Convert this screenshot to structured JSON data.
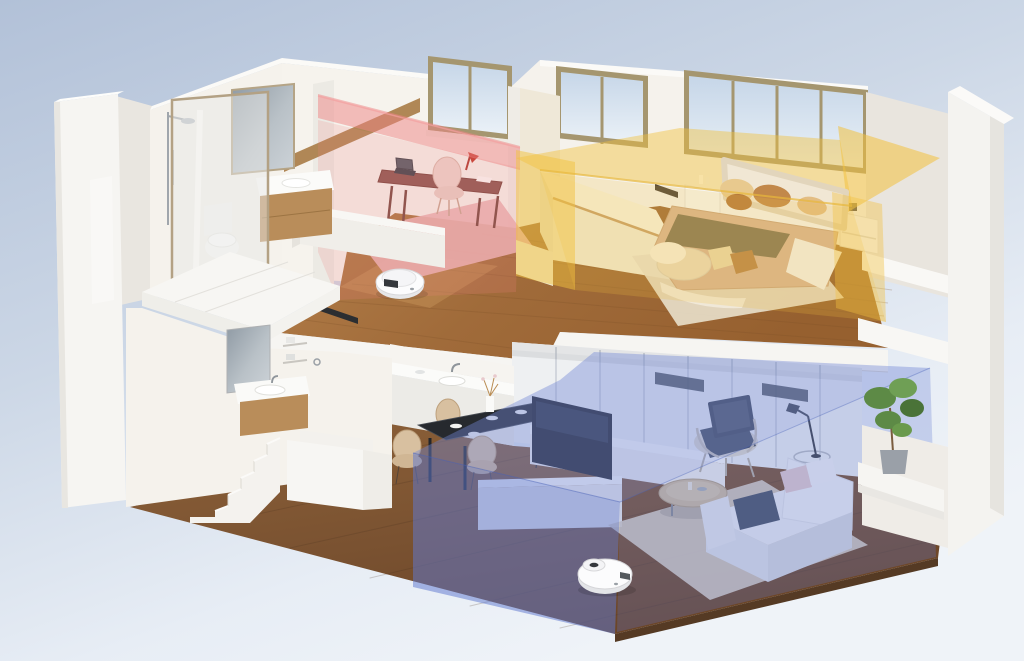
{
  "meta": {
    "kind": "3d-isometric-cutaway-render",
    "description": "Two-story apartment cutaway with robot vacuum cleaners; three highlighted cleaning zones (study red, bedroom yellow, living room blue)",
    "width": 1024,
    "height": 661
  },
  "scene": {
    "colors": {
      "sky_top": "#b2c1d8",
      "sky_bottom": "#eef2f8",
      "wall_white": "#f5f2ec",
      "wall_shadow": "#e9e5de",
      "slab_white": "#f6f5f2",
      "panel_white": "#eef0f2",
      "zone_red": "#ee8383",
      "zone_yellow": "#f2c13e",
      "zone_blue": "#5f78d0",
      "zone_blue_top": "#7289d6",
      "robot_body": "#fcfcfd",
      "robot_detail": "#35383d",
      "table_dark": "#26292e",
      "chair_tan": "#d8c0a0",
      "tv_dark": "#1f2228",
      "sofa_light": "#eceef2",
      "pillow_navy": "#4a5466",
      "duvet_tan": "#d8b493",
      "pillow_brown": "#c2884a",
      "headboard_cream": "#f1e7d4",
      "rug_pink": "#e9b5b5",
      "rug_cream": "#e7ddc8",
      "rug_living": "#d8cfc1",
      "desk_wood": "#8d5750",
      "lamp_red": "#c0392b",
      "beam_wood": "#b08756",
      "plant_green": "#5d8a46",
      "pot_gray": "#9aa0a8",
      "cabinet_wood": "#b98d5a",
      "glass_frame": "#a5966f"
    },
    "floors": [
      {
        "name": "upper",
        "rooms": [
          {
            "name": "bathroom",
            "fixtures": [
              "shower-set",
              "glass-screen",
              "toilet",
              "vanity-sink",
              "mirror"
            ]
          },
          {
            "name": "study",
            "zone": "red",
            "furniture": [
              "desk",
              "laptop",
              "desk-lamp",
              "chair",
              "pink-rug",
              "window",
              "wood-beam"
            ]
          },
          {
            "name": "bedroom",
            "zone": "yellow",
            "furniture": [
              "double-bed",
              "headboard",
              "pillows",
              "nightstands",
              "low-cabinet",
              "cream-rug",
              "pouf",
              "floor-cushions",
              "windows"
            ]
          }
        ],
        "robot": {
          "name": "robot-vacuum",
          "x": 400,
          "y": 282
        }
      },
      {
        "name": "lower",
        "rooms": [
          {
            "name": "stair-hall",
            "fixtures": [
              "staircase",
              "wash-basin",
              "mirror",
              "wall-shelves"
            ]
          },
          {
            "name": "kitchen-dining",
            "furniture": [
              "kitchen-counter",
              "sink",
              "dining-table",
              "dining-chairs",
              "vase"
            ]
          },
          {
            "name": "living-room",
            "zone": "blue",
            "furniture": [
              "tv",
              "media-console",
              "low-bench",
              "armchair",
              "floor-lamp",
              "side-table",
              "sofa",
              "coffee-table",
              "rug",
              "potted-plant",
              "wall-cabinets"
            ]
          }
        ],
        "robot": {
          "name": "robot-vacuum",
          "x": 605,
          "y": 574
        }
      }
    ]
  }
}
